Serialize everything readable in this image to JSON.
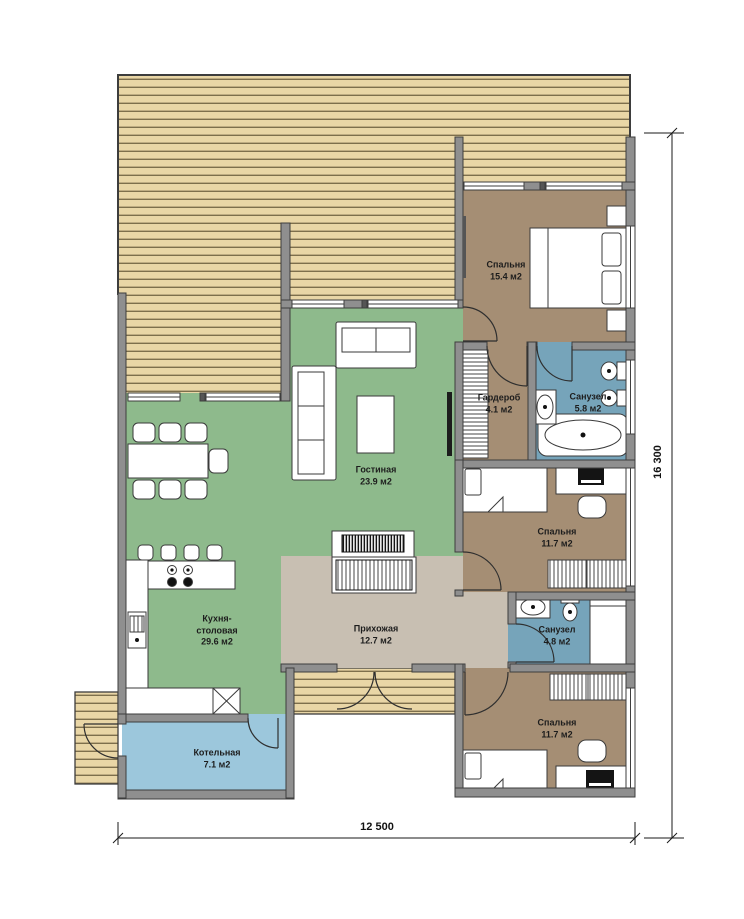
{
  "plan": {
    "title": "one-storey house floor plan",
    "rooms": [
      {
        "id": "bedroom-master",
        "name": "Спальня",
        "area": "15.4 м2"
      },
      {
        "id": "wardrobe",
        "name": "Гардероб",
        "area": "4.1 м2"
      },
      {
        "id": "bathroom-main",
        "name": "Санузел",
        "area": "5.8 м2"
      },
      {
        "id": "living-room",
        "name": "Гостиная",
        "area": "23.9 м2"
      },
      {
        "id": "kitchen-dining",
        "name": "Кухня-столовая",
        "area": "29.6 м2"
      },
      {
        "id": "hallway",
        "name": "Прихожая",
        "area": "12.7 м2"
      },
      {
        "id": "bathroom-small",
        "name": "Санузел",
        "area": "4.8 м2"
      },
      {
        "id": "bedroom-middle",
        "name": "Спальня",
        "area": "11.7 м2"
      },
      {
        "id": "bedroom-south",
        "name": "Спальня",
        "area": "11.7 м2"
      },
      {
        "id": "boiler-room",
        "name": "Котельная",
        "area": "7.1 м2"
      }
    ],
    "dimensions": {
      "width_label": "12 500",
      "height_label": "16 300"
    },
    "colors": {
      "deck_wood": "#e9d6a6",
      "deck_line": "#7d6f4c",
      "wall_fill": "#8f8f8f",
      "wall_outline": "#3d3d3d",
      "bedroom_floor": "#a58e74",
      "bathroom_floor": "#76a4ba",
      "boiler_floor": "#9cc7dc",
      "living_floor": "#8eba8c",
      "hallway_floor": "#c8bfb2",
      "furniture": "#ffffff"
    }
  }
}
